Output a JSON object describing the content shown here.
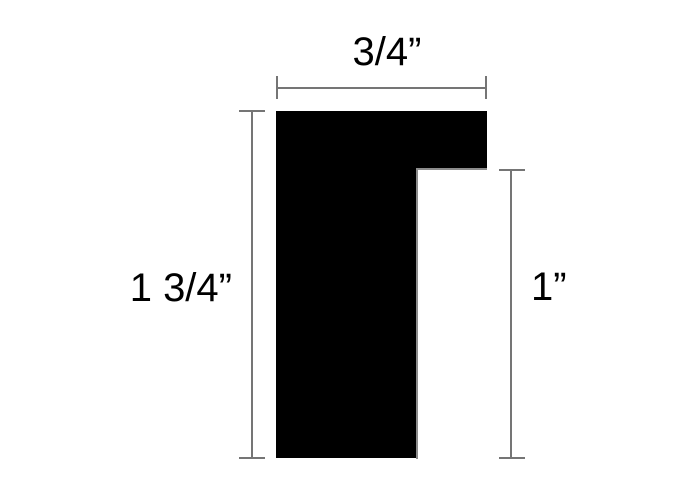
{
  "figure": {
    "type": "technical-dimension-diagram",
    "subject": "moulding-profile-cross-section",
    "background_color": "#ffffff",
    "profile_color": "#000000",
    "dimension_line_color": "#757575",
    "notch_edge_color": "#8c8c8c",
    "dimensions": {
      "top_width": "3/4”",
      "left_height": "1 3/4”",
      "right_height": "1”"
    }
  }
}
